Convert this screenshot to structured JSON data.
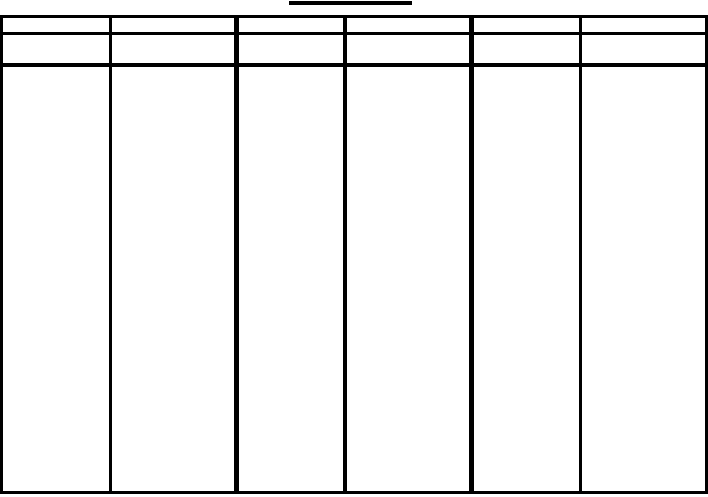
{
  "page": {
    "background_color": "#ffffff",
    "line_color": "#000000"
  },
  "title": {
    "text": "",
    "underline_present": true
  },
  "table": {
    "column_count": 6,
    "row_count": 3,
    "header_row_1": [
      "",
      "",
      "",
      "",
      "",
      ""
    ],
    "header_row_2": [
      "",
      "",
      "",
      "",
      "",
      ""
    ],
    "body_row": [
      "",
      "",
      "",
      "",
      "",
      ""
    ]
  }
}
